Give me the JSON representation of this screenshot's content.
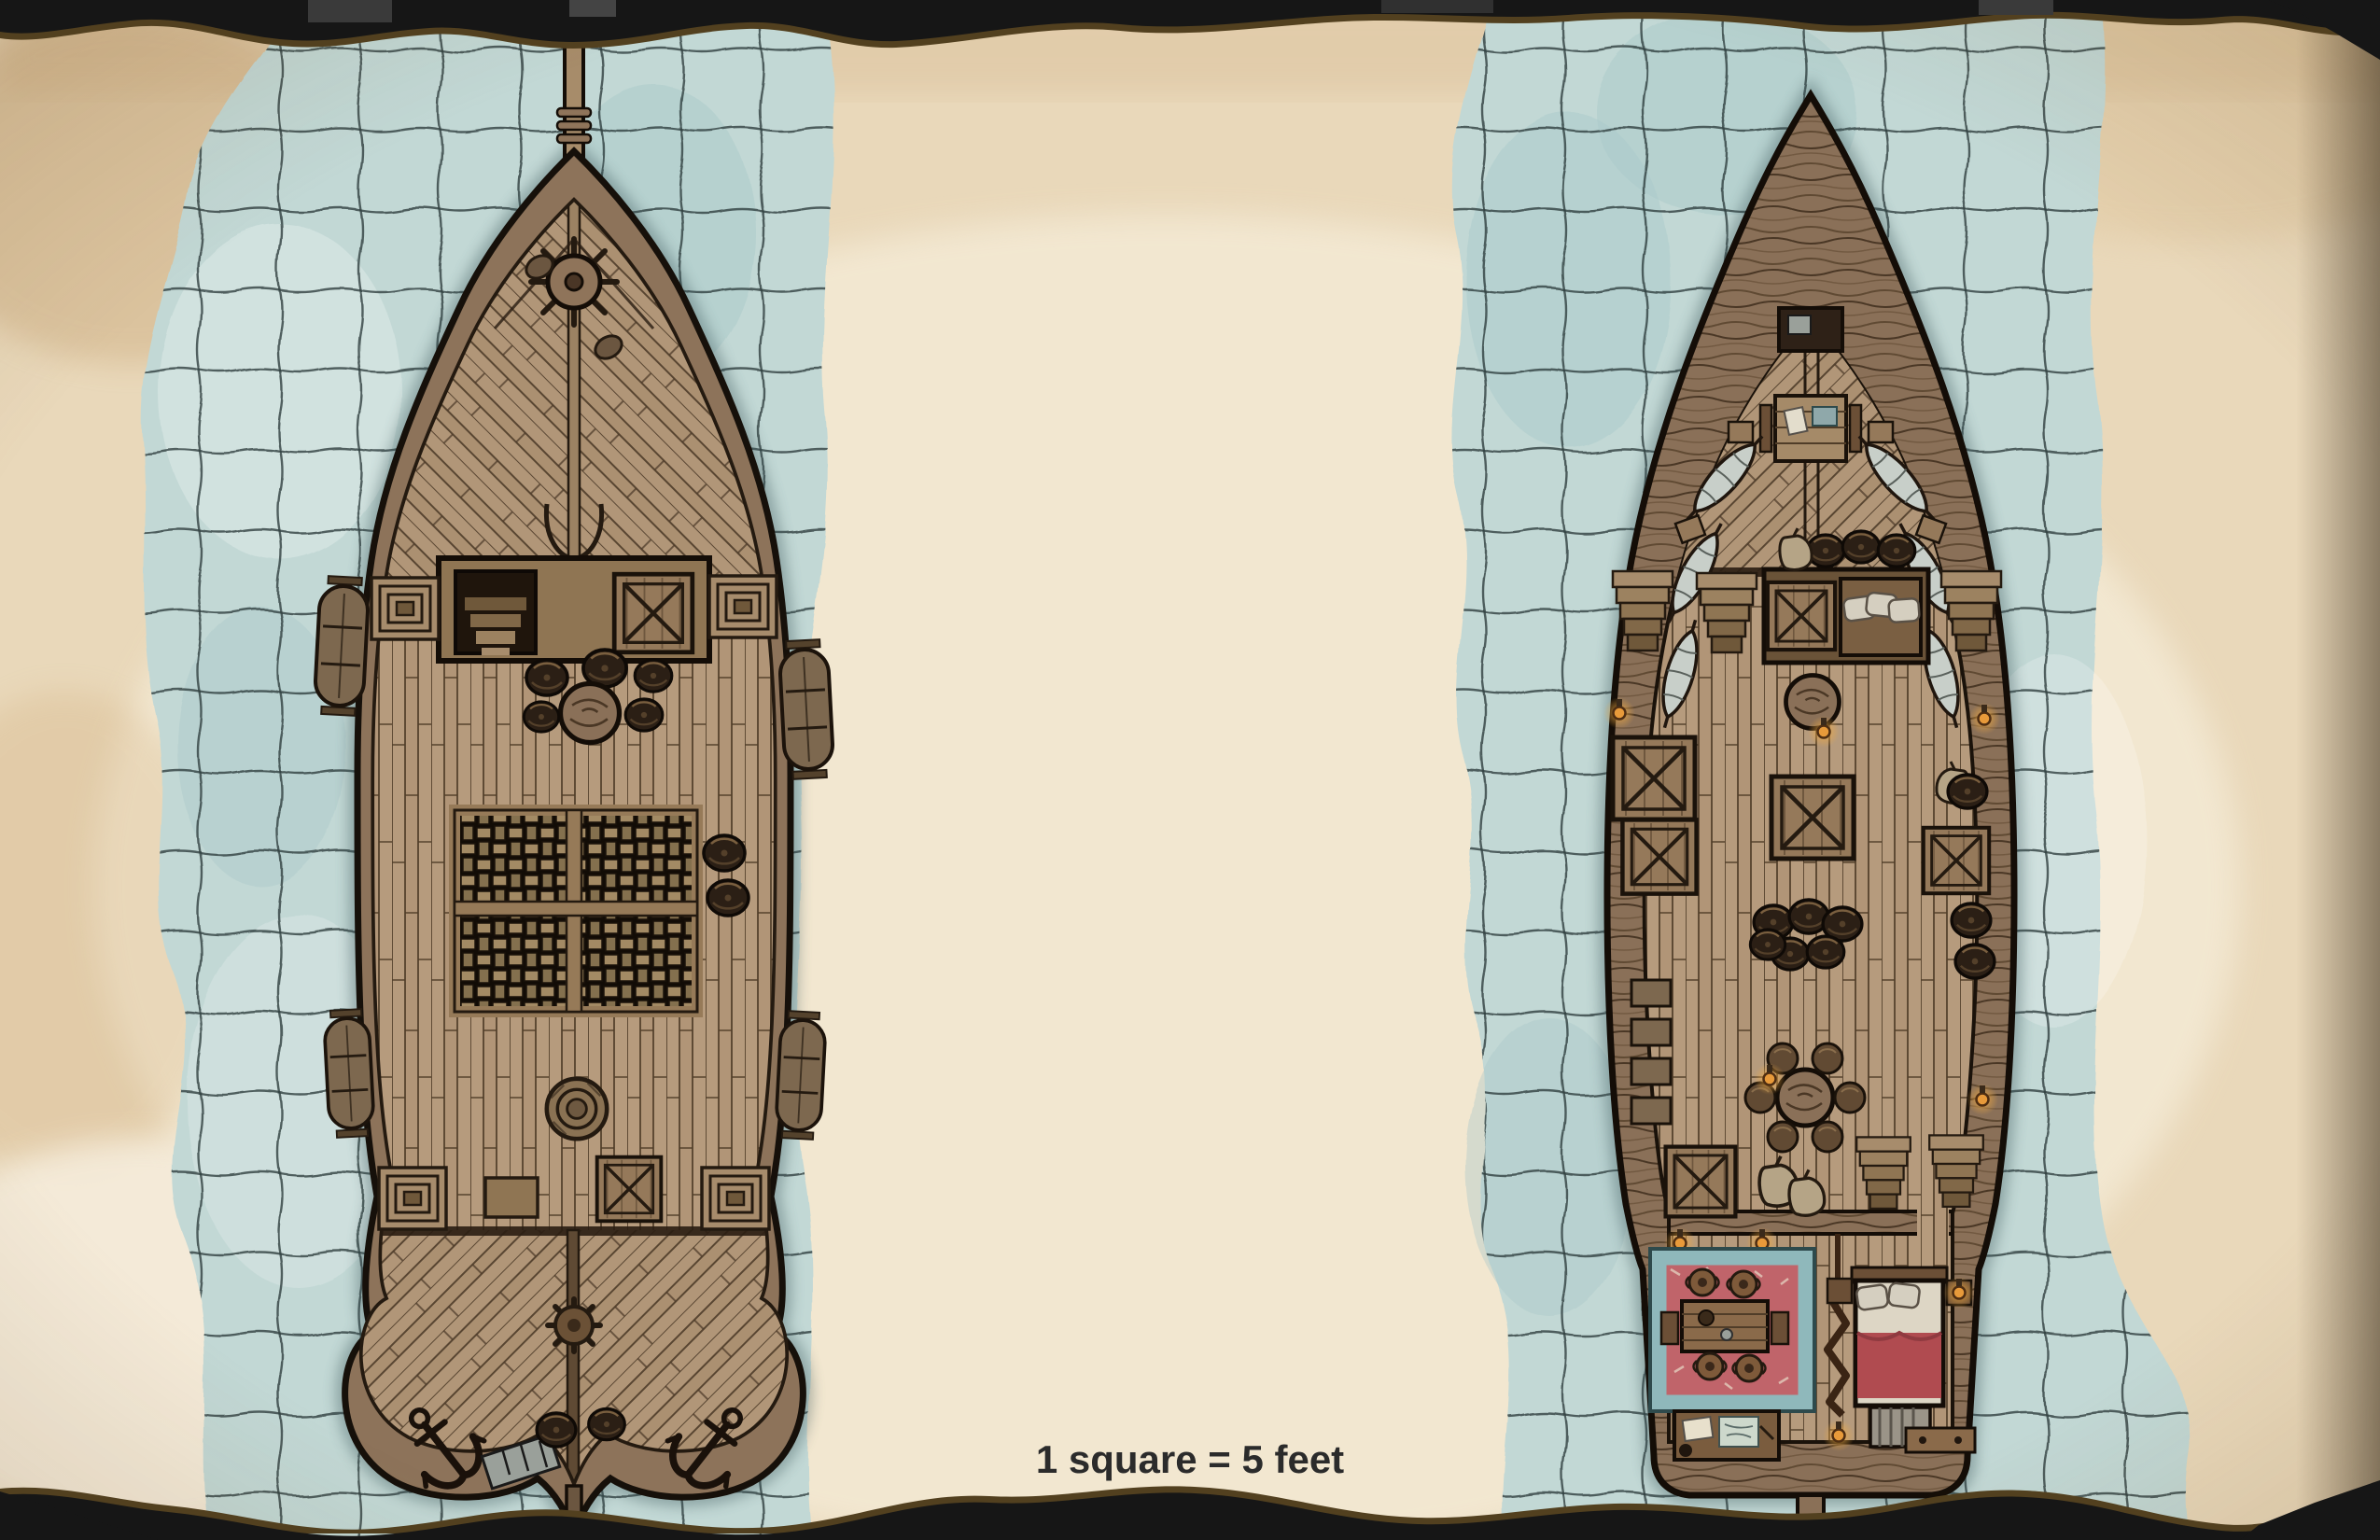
{
  "map": {
    "kind": "ttrpg ship battle map, hand-drawn watercolor on torn parchment",
    "scale_label": "1 square = 5 feet",
    "grid": {
      "cell_size_px": 86,
      "feet_per_square": 5,
      "line_color": "#2f3e3e",
      "drawn_only_over_water": true
    },
    "palette": {
      "backdrop": "#141414",
      "parchment": "#e9d8ba",
      "parchment_light": "#f5ecd8",
      "stain_brown": "#b98f58",
      "water": "#c2d8d5",
      "water_shadow": "#3c585c",
      "grid_line": "#2f3e3e",
      "hull_wood": "#8d735a",
      "deck_plank": "#b69b7d",
      "outline": "#16100a",
      "grate_straps": "#a38a64",
      "rug_border_teal": "#8fb8bb",
      "rug_red": "#c0646a",
      "blanket_red": "#b04b50",
      "lantern_orange": "#e89a3a",
      "torn_fringe": "#52401f"
    },
    "ships": [
      {
        "name": "ship-weather-deck",
        "view": "weather deck, top-down",
        "items": [
          "bowsprit",
          "bow-rigging-ropes",
          "windlass-wheel",
          "mooring-cleats",
          "companionway-stairs",
          "cargo-hatch",
          "rail-stairs",
          "barrel-cluster",
          "rope-coils",
          "cargo-grate",
          "deck-barrels",
          "ship-boats",
          "crate",
          "capstan-gear",
          "deck-spine",
          "anchors",
          "supply-box",
          "stern-barrels",
          "rudder-post"
        ]
      },
      {
        "name": "ship-lower-deck",
        "view": "lower deck interior, top-down",
        "items": [
          "carved-prow",
          "bow-locker",
          "mess-table",
          "crew-hammocks",
          "hammock-crates",
          "stairs",
          "stair-platform",
          "pillow-crate",
          "barrel-row",
          "sack",
          "mast-column",
          "lanterns",
          "cargo-crates",
          "barrel-cluster",
          "crew-benches",
          "round-table",
          "stools",
          "stair-pair",
          "sacks",
          "bulkhead-wall",
          "door-gap",
          "captains-rug",
          "captains-table",
          "jugs",
          "chairs",
          "writing-desk",
          "papers-and-map",
          "folding-screen",
          "bed",
          "pillows",
          "red-blanket",
          "striped-chest",
          "night-tables",
          "stern-bench",
          "rudder-post"
        ]
      }
    ]
  }
}
